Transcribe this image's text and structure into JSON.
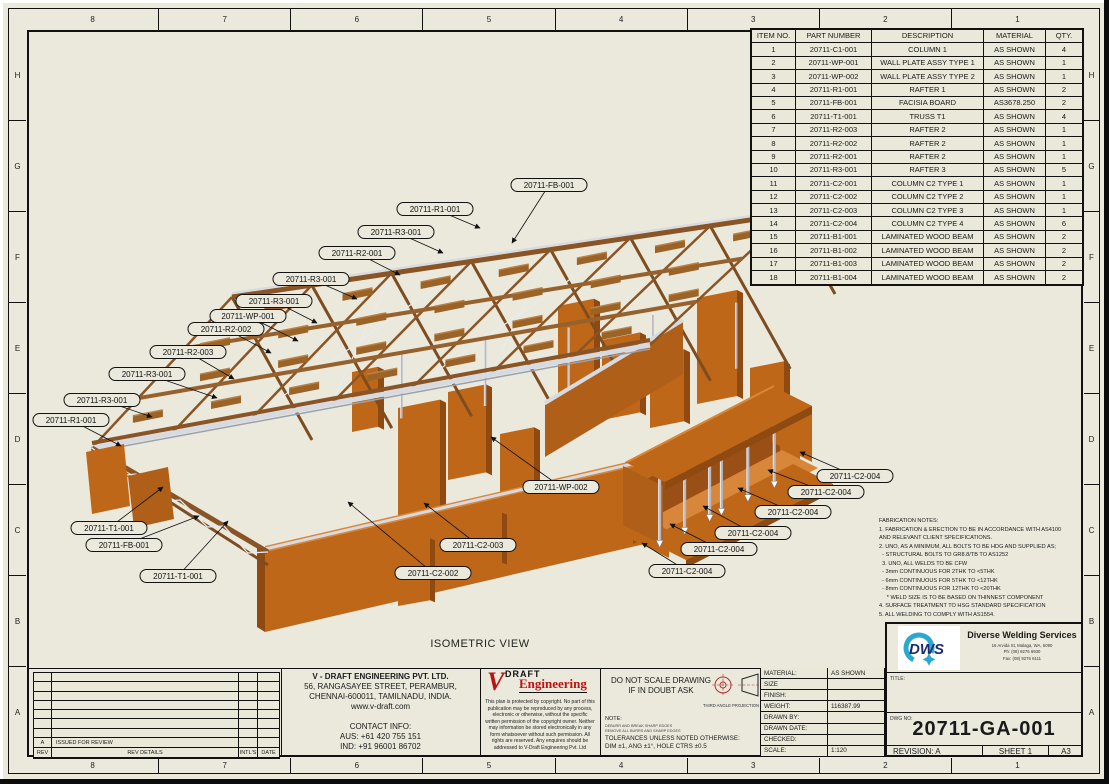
{
  "sheet": {
    "zones": {
      "columns": [
        "8",
        "7",
        "6",
        "5",
        "4",
        "3",
        "2",
        "1"
      ],
      "rows": [
        "H",
        "G",
        "F",
        "E",
        "D",
        "C",
        "B",
        "A"
      ]
    },
    "view_label": "ISOMETRIC VIEW"
  },
  "parts_table": {
    "headers": [
      "ITEM NO.",
      "PART NUMBER",
      "DESCRIPTION",
      "MATERIAL",
      "QTY."
    ],
    "rows": [
      [
        "1",
        "20711-C1-001",
        "COLUMN 1",
        "AS SHOWN",
        "4"
      ],
      [
        "2",
        "20711-WP-001",
        "WALL PLATE ASSY TYPE 1",
        "AS SHOWN",
        "1"
      ],
      [
        "3",
        "20711-WP-002",
        "WALL PLATE ASSY TYPE 2",
        "AS SHOWN",
        "1"
      ],
      [
        "4",
        "20711-R1-001",
        "RAFTER 1",
        "AS SHOWN",
        "2"
      ],
      [
        "5",
        "20711-FB-001",
        "FACISIA BOARD",
        "AS3678.250",
        "2"
      ],
      [
        "6",
        "20711-T1-001",
        "TRUSS T1",
        "AS SHOWN",
        "4"
      ],
      [
        "7",
        "20711-R2-003",
        "RAFTER 2",
        "AS SHOWN",
        "1"
      ],
      [
        "8",
        "20711-R2-002",
        "RAFTER 2",
        "AS SHOWN",
        "1"
      ],
      [
        "9",
        "20711-R2-001",
        "RAFTER 2",
        "AS SHOWN",
        "1"
      ],
      [
        "10",
        "20711-R3-001",
        "RAFTER 3",
        "AS SHOWN",
        "5"
      ],
      [
        "11",
        "20711-C2-001",
        "COLUMN C2 TYPE 1",
        "AS SHOWN",
        "1"
      ],
      [
        "12",
        "20711-C2-002",
        "COLUMN C2 TYPE 2",
        "AS SHOWN",
        "1"
      ],
      [
        "13",
        "20711-C2-003",
        "COLUMN C2 TYPE 3",
        "AS SHOWN",
        "1"
      ],
      [
        "14",
        "20711-C2-004",
        "COLUMN C2 TYPE 4",
        "AS SHOWN",
        "6"
      ],
      [
        "15",
        "20711-B1-001",
        "LAMINATED WOOD BEAM",
        "AS SHOWN",
        "2"
      ],
      [
        "16",
        "20711-B1-002",
        "LAMINATED WOOD BEAM",
        "AS SHOWN",
        "2"
      ],
      [
        "17",
        "20711-B1-003",
        "LAMINATED WOOD BEAM",
        "AS SHOWN",
        "2"
      ],
      [
        "18",
        "20711-B1-004",
        "LAMINATED WOOD BEAM",
        "AS SHOWN",
        "2"
      ]
    ]
  },
  "callouts": [
    {
      "label": "20711-FB-001",
      "x": 549,
      "y": 185,
      "tx": 512,
      "ty": 243
    },
    {
      "label": "20711-R1-001",
      "x": 435,
      "y": 209,
      "tx": 480,
      "ty": 228
    },
    {
      "label": "20711-R3-001",
      "x": 396,
      "y": 232,
      "tx": 443,
      "ty": 253
    },
    {
      "label": "20711-R2-001",
      "x": 357,
      "y": 253,
      "tx": 400,
      "ty": 275
    },
    {
      "label": "20711-R3-001",
      "x": 311,
      "y": 279,
      "tx": 357,
      "ty": 299
    },
    {
      "label": "20711-R3-001",
      "x": 274,
      "y": 301,
      "tx": 317,
      "ty": 323
    },
    {
      "label": "20711-WP-001",
      "x": 248,
      "y": 316,
      "tx": 298,
      "ty": 341
    },
    {
      "label": "20711-R2-002",
      "x": 226,
      "y": 329,
      "tx": 271,
      "ty": 353
    },
    {
      "label": "20711-R2-003",
      "x": 188,
      "y": 352,
      "tx": 234,
      "ty": 379
    },
    {
      "label": "20711-R3-001",
      "x": 147,
      "y": 374,
      "tx": 217,
      "ty": 398
    },
    {
      "label": "20711-R3-001",
      "x": 102,
      "y": 400,
      "tx": 152,
      "ty": 417
    },
    {
      "label": "20711-R1-001",
      "x": 71,
      "y": 420,
      "tx": 121,
      "ty": 446
    },
    {
      "label": "20711-T1-001",
      "x": 109,
      "y": 528,
      "tx": 163,
      "ty": 487
    },
    {
      "label": "20711-FB-001",
      "x": 124,
      "y": 545,
      "tx": 199,
      "ty": 516
    },
    {
      "label": "20711-T1-001",
      "x": 178,
      "y": 576,
      "tx": 228,
      "ty": 521
    },
    {
      "label": "20711-WP-002",
      "x": 561,
      "y": 487,
      "tx": 491,
      "ty": 437
    },
    {
      "label": "20711-C2-003",
      "x": 478,
      "y": 545,
      "tx": 424,
      "ty": 503
    },
    {
      "label": "20711-C2-002",
      "x": 433,
      "y": 573,
      "tx": 348,
      "ty": 502
    },
    {
      "label": "20711-C2-004",
      "x": 855,
      "y": 476,
      "tx": 800,
      "ty": 452
    },
    {
      "label": "20711-C2-004",
      "x": 826,
      "y": 492,
      "tx": 768,
      "ty": 470
    },
    {
      "label": "20711-C2-004",
      "x": 793,
      "y": 512,
      "tx": 738,
      "ty": 488
    },
    {
      "label": "20711-C2-004",
      "x": 753,
      "y": 533,
      "tx": 703,
      "ty": 506
    },
    {
      "label": "20711-C2-004",
      "x": 719,
      "y": 549,
      "tx": 670,
      "ty": 524
    },
    {
      "label": "20711-C2-004",
      "x": 687,
      "y": 571,
      "tx": 642,
      "ty": 543
    }
  ],
  "fabrication_notes": [
    "FABRICATION NOTES:",
    "1. FABRICATION & ERECTION TO BE IN ACCORDANCE WITH AS4100",
    "AND RELEVANT CLIENT SPECIFICATIONS.",
    "2. UNO, AS A MINIMUM, ALL BOLTS TO BE HDG AND SUPPLIED AS;",
    "  - STRUCTURAL BOLTS TO GR8.8/TB TO AS1252",
    "  3. UNO, ALL WELDS TO BE CFW",
    "  - 3mm CONTINUOUS FOR 2THK TO <5THK",
    "  - 6mm CONTINUOUS FOR 5THK TO <12THK",
    "  - 8mm CONTINUOUS FOR 12THK TO <20THK",
    "     * WELD SIZE IS TO BE BASED ON THINNEST COMPONENT",
    "4. SURFACE TREATMENT TO HSG STANDARD SPECIFICATION",
    "5. ALL WELDING TO COMPLY WITH AS1554."
  ],
  "revision_table": {
    "headers": [
      "REV",
      "REV DETAILS",
      "INTL'S",
      "DATE"
    ],
    "empty_row_count": 7,
    "rows": [
      [
        "A",
        "ISSUED FOR REVIEW",
        "",
        ""
      ]
    ]
  },
  "title_block": {
    "company": {
      "name": "V - DRAFT ENGINEERING PVT. LTD.",
      "address": [
        "56, RANGASAYEE STREET, PERAMBUR,",
        "CHENNAI-600011, TAMILNADU, INDIA.",
        "www.v-draft.com"
      ],
      "contact_heading": "CONTACT INFO:",
      "contact": [
        "AUS: +61 420 755 151",
        "IND: +91 96001 86702"
      ]
    },
    "vdraft_logo": {
      "v": "V",
      "draft": "DRAFT",
      "engineering": "Engineering"
    },
    "copyright": "This plan is protected by copyright. No part of this publication may be reproduced by any process, electronic or otherwise, without the specific written permission of the copyright owner. Neither may information be stored electronically in any form whatsoever without such permission. All rights are reserved. Any enquires should be addressed to V-Draft Engineering Pvt. Ltd",
    "do_not_scale": [
      "DO NOT SCALE DRAWING",
      "IF IN DOUBT ASK"
    ],
    "projection_label": "THIRD ANGLE PROJECTION",
    "note_label": "NOTE:",
    "note_small": [
      "DEBURR AND BREAK SHARP EDGES",
      "REMOVE ALL BURRS AND SHARP EDGES"
    ],
    "tolerances": [
      "TOLERANCES UNLESS NOTED OTHERWISE:",
      "DIM ±1, ANG ±1°, HOLE CTRS ±0.5"
    ],
    "fields": [
      [
        "MATERIAL:",
        "AS SHOWN"
      ],
      [
        "SIZE",
        ""
      ],
      [
        "FINISH:",
        ""
      ],
      [
        "WEIGHT:",
        "116387.99"
      ],
      [
        "DRAWN BY:",
        ""
      ],
      [
        "DRAWN DATE:",
        ""
      ],
      [
        "CHECKED:",
        ""
      ],
      [
        "SCALE:",
        "1:120"
      ]
    ],
    "dws": {
      "logo_text": "DWS",
      "name": "Diverse Welding Services",
      "address": [
        "16 Arvida St, Malaga, WA, 6090",
        "Ph:  (08) 9276 6930",
        "Fax: (08) 9276 6111"
      ]
    },
    "title_label": "TITLE:",
    "dwg_no_label": "DWG NO:",
    "dwg_no": "20711-GA-001",
    "revision": "REVISION:  A",
    "sheet_no": "SHEET 1",
    "paper_size": "A3"
  },
  "colors": {
    "sheet_bg": "#eae9dc",
    "wood_orange": "#bf6719",
    "wood_brown": "#8a5526",
    "steel_grey": "#b4b8c2",
    "logo_red": "#b81414",
    "dws_cyan": "#2aa9cf",
    "dws_navy": "#1b2a70"
  }
}
